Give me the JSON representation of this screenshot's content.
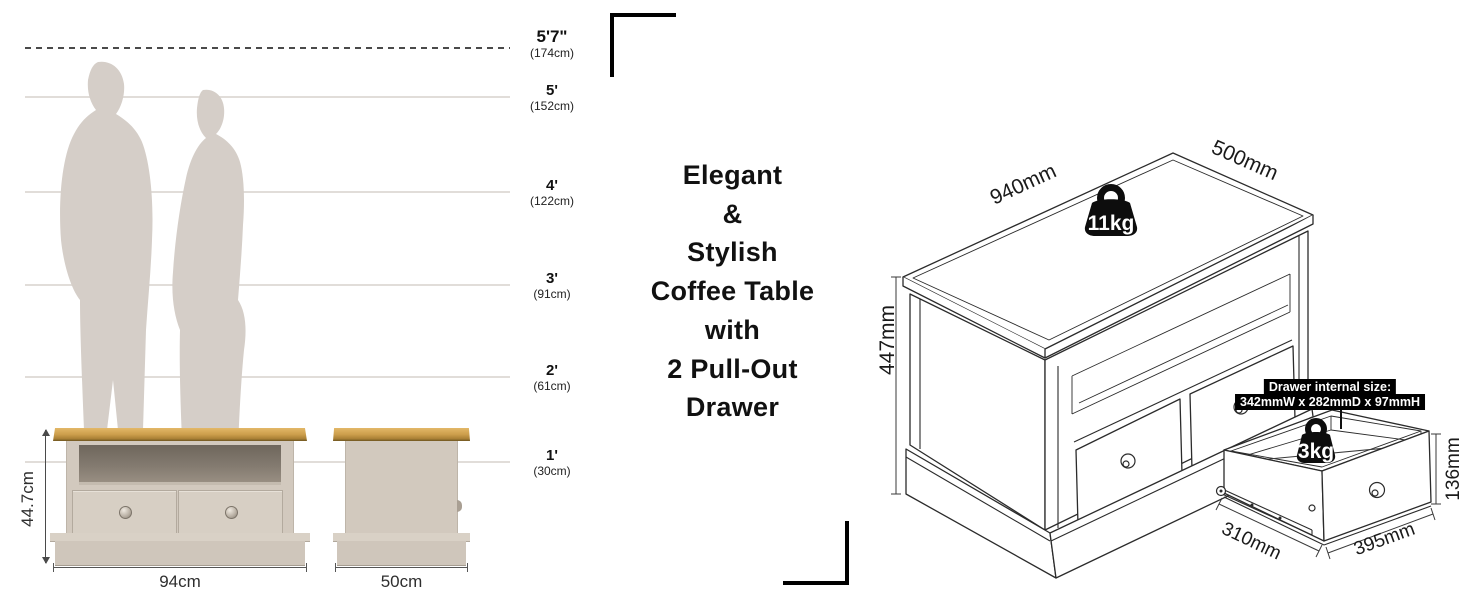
{
  "headline": {
    "lines": [
      "Elegant",
      "&",
      "Stylish",
      "Coffee Table",
      "with",
      "2 Pull-Out",
      "Drawer"
    ]
  },
  "height_chart": {
    "markers": [
      {
        "feet": "5'7\"",
        "cm": "(174cm)"
      },
      {
        "feet": "5'",
        "cm": "(152cm)"
      },
      {
        "feet": "4'",
        "cm": "(122cm)"
      },
      {
        "feet": "3'",
        "cm": "(91cm)"
      },
      {
        "feet": "2'",
        "cm": "(61cm)"
      },
      {
        "feet": "1'",
        "cm": "(30cm)"
      }
    ]
  },
  "front_view": {
    "height_label": "44.7cm",
    "width_label": "94cm"
  },
  "side_view": {
    "width_label": "50cm"
  },
  "table_3d": {
    "width_label": "940mm",
    "depth_label": "500mm",
    "height_label": "447mm",
    "weight_label": "11kg"
  },
  "drawer_3d": {
    "note_line1": "Drawer internal size:",
    "note_line2": "342mmW x 282mmD x 97mmH",
    "width_label": "310mm",
    "depth_label": "395mm",
    "height_label": "136mm",
    "weight_label": "3kg"
  },
  "colors": {
    "wood": "#c79a48",
    "body": "#d2c9be",
    "silhouette": "#d5cec8",
    "line_art": "#2b2b2b"
  }
}
